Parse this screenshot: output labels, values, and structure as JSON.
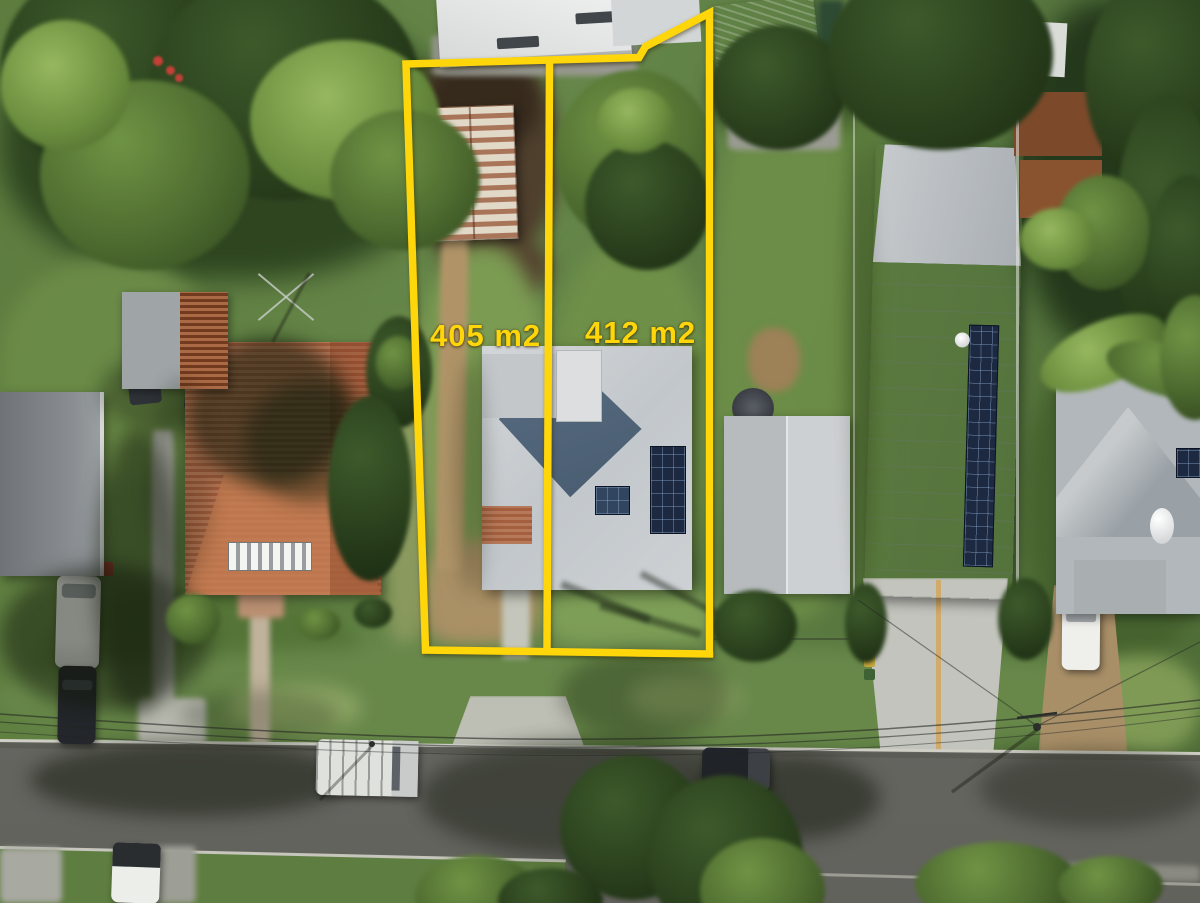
{
  "scene": {
    "kind": "aerial-drone-photo",
    "description": "Top-down drone photo of a residential street; two adjacent subdivided lots outlined in yellow"
  },
  "overlay": {
    "accent_color": "#FFD60A",
    "lots": [
      {
        "name": "left-lot",
        "label": "405 m2"
      },
      {
        "name": "right-lot",
        "label": "412 m2"
      }
    ]
  }
}
